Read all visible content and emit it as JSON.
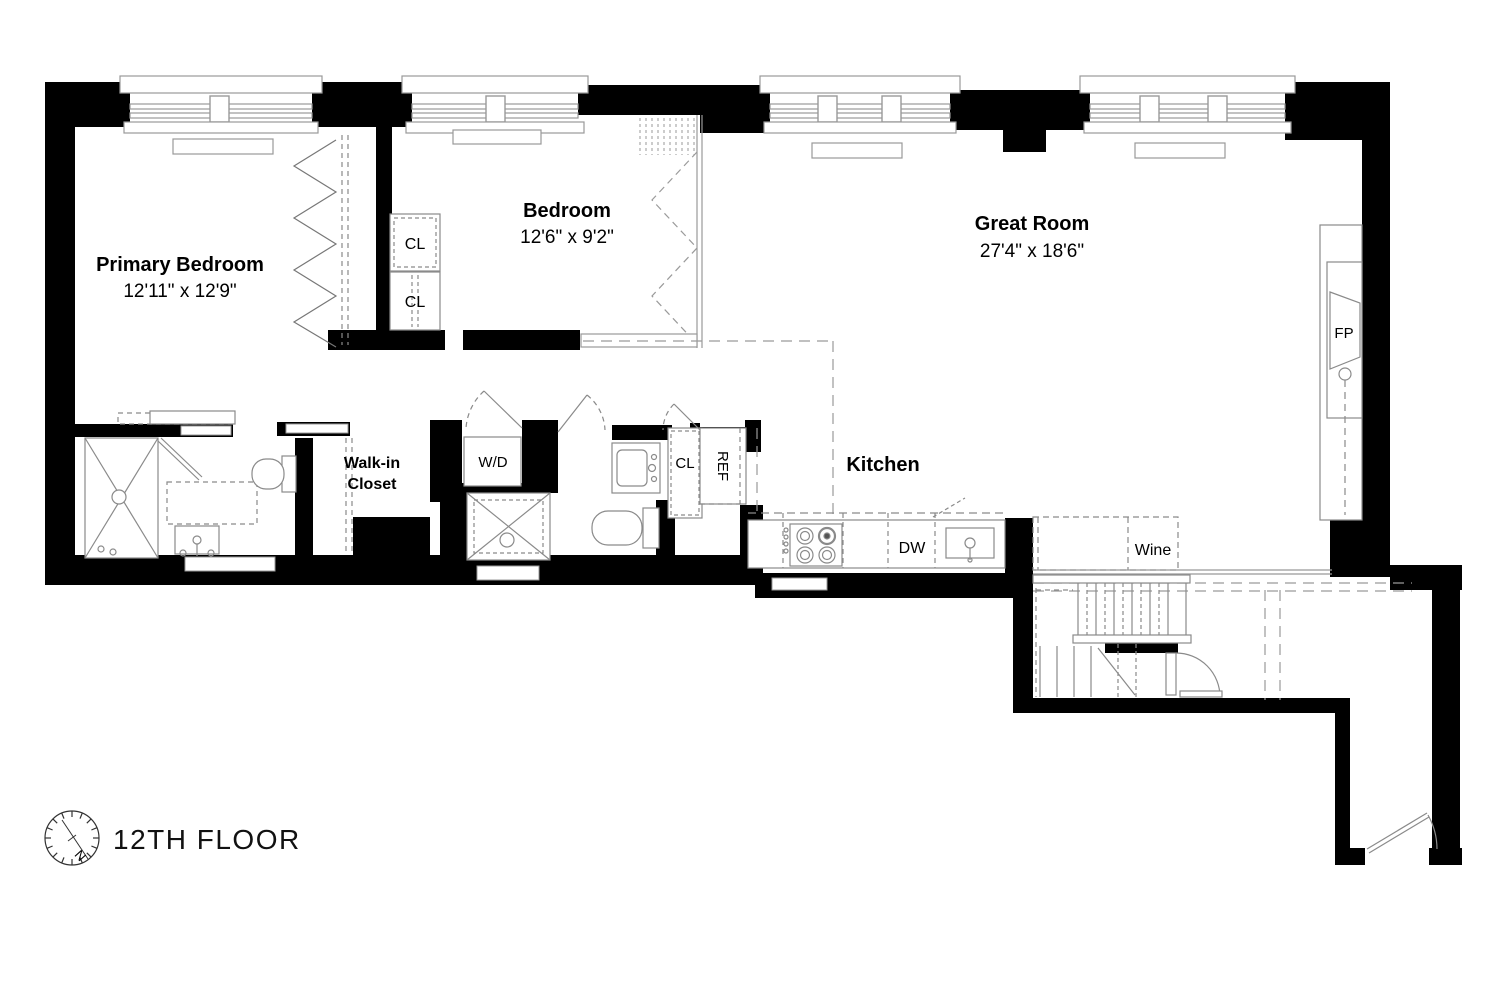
{
  "plan": {
    "floor_label": "12TH FLOOR",
    "compass": {
      "north_label": "N"
    },
    "rooms": {
      "primary_bedroom": {
        "name": "Primary Bedroom",
        "dims": "12'11\" x 12'9\""
      },
      "bedroom": {
        "name": "Bedroom",
        "dims": "12'6\" x 9'2\""
      },
      "great_room": {
        "name": "Great Room",
        "dims": "27'4\" x 18'6\""
      },
      "kitchen": {
        "name": "Kitchen"
      },
      "walk_in_closet": {
        "line1": "Walk-in",
        "line2": "Closet"
      }
    },
    "fixtures": {
      "washer_dryer": "W/D",
      "closet_1": "CL",
      "closet_2": "CL",
      "closet_3": "CL",
      "refrigerator": "REF",
      "dishwasher": "DW",
      "wine_cooler": "Wine",
      "fireplace": "FP"
    },
    "colors": {
      "wall": "#000000",
      "fixture_line": "#8a8a8a",
      "dashed_line": "#9a9a9a",
      "text": "#000000",
      "background": "#ffffff"
    }
  }
}
